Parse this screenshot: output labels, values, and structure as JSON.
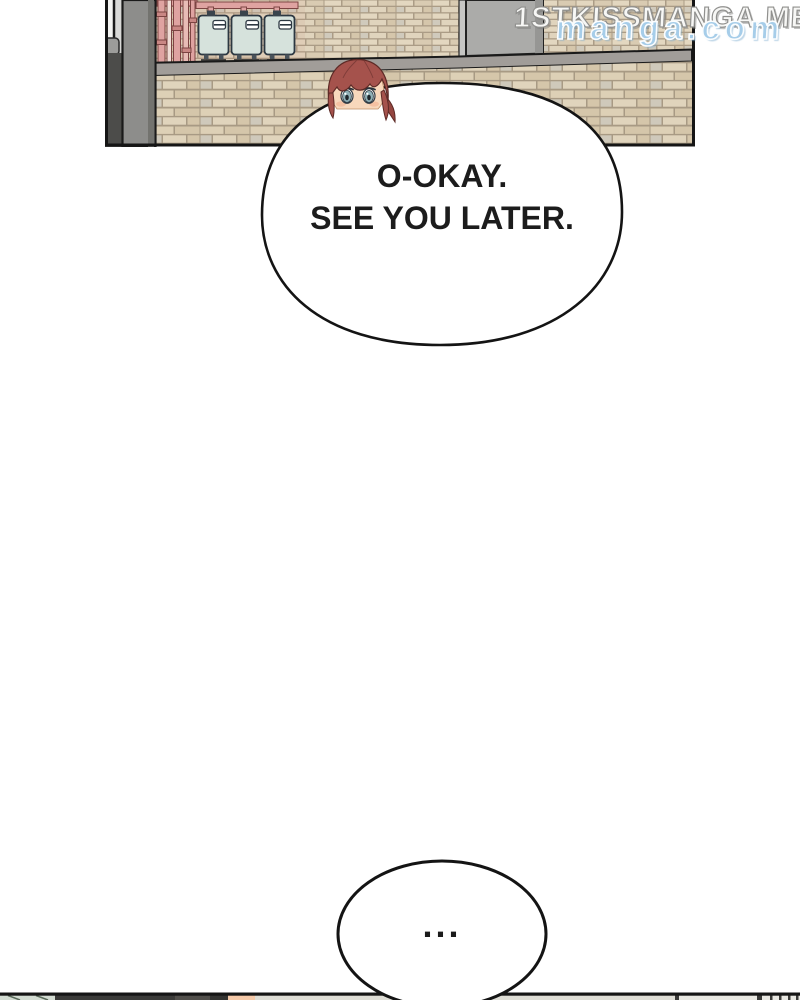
{
  "comic": {
    "panel1": {
      "description": "Exterior alley wall of a building: beige brick walls, dark gray pillar, pink gas pipes, three pale-blue gas meters, gray metal door; a girl with auburn hair peeks over a large speech bubble",
      "gas_meter_count": "3",
      "speech_bubble": {
        "lines": [
          "O-OKAY.",
          "SEE YOU LATER."
        ]
      }
    },
    "panel2": {
      "description": "Thin sliver of the next panel at the page bottom with a small speech bubble",
      "speech_bubble": {
        "text": "..."
      }
    },
    "watermark": {
      "primary": "1STKISSMANGA.ME",
      "secondary": "manga.com"
    },
    "colors": {
      "brick_light": "#e3d7c0",
      "brick_mid": "#d9cbb2",
      "mortar": "#ab9c86",
      "pillar_gray": "#8d8d8b",
      "ledge_gray": "#a19d99",
      "door_gray": "#ababa9",
      "pipe_pink": "#dfa3a1",
      "meter_body": "#d6e2dc",
      "meter_outline": "#2c3741",
      "hair_auburn": "#a5524c",
      "skin": "#f8d8bc",
      "eye_teal": "#8fb0b6",
      "watermark_blue": "#a6cde9",
      "outline_black": "#151515"
    }
  }
}
